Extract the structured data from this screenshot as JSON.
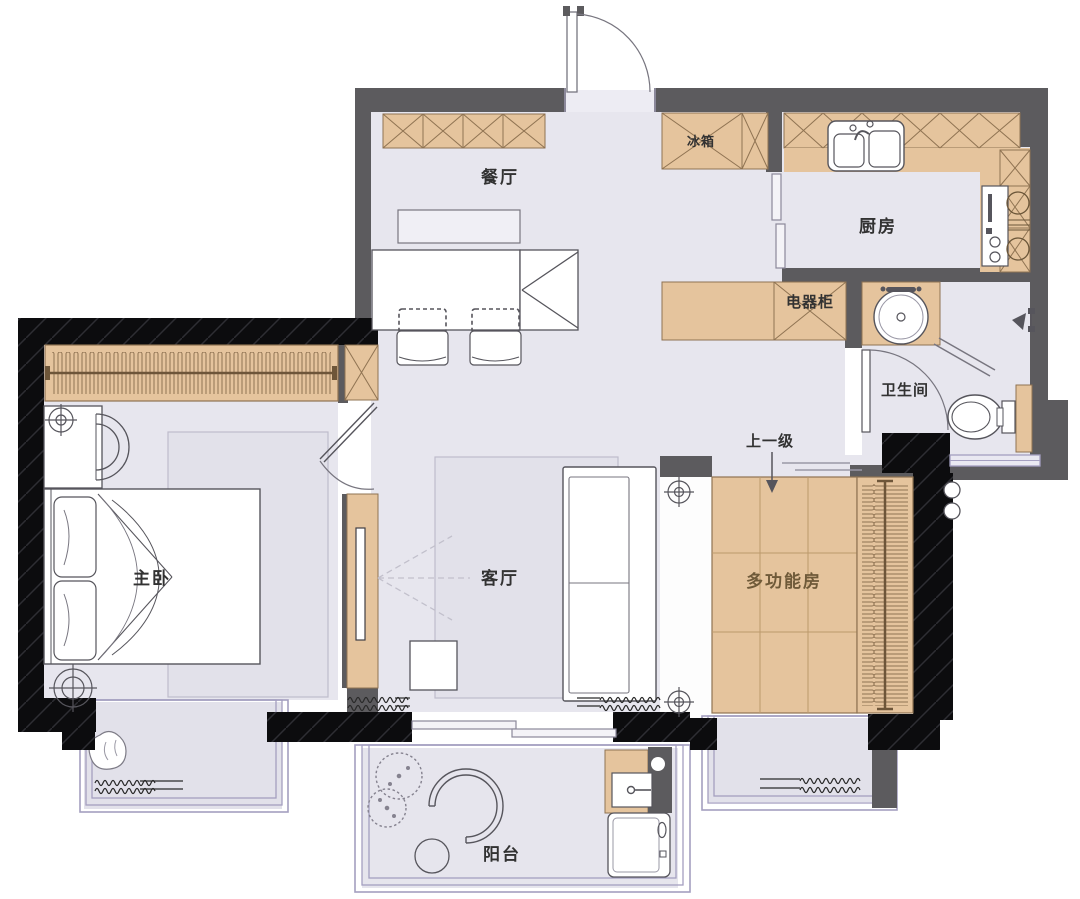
{
  "labels": {
    "dining": "餐厅",
    "fridge": "冰箱",
    "kitchen": "厨房",
    "appliance_cabinet": "电器柜",
    "bathroom": "卫生间",
    "master_bedroom": "主卧",
    "living": "客厅",
    "multi_room": "多功能房",
    "step_up": "上一级",
    "balcony": "阳台"
  },
  "rooms": [
    {
      "id": "dining-room",
      "label": "餐厅",
      "fixtures": [
        "storage-cabinets",
        "dining-table",
        "two-chairs",
        "wall-shelf"
      ]
    },
    {
      "id": "kitchen",
      "label": "厨房",
      "fixtures": [
        "upper-cabinets",
        "double-sink",
        "cooktop",
        "sliding-door",
        "refrigerator"
      ]
    },
    {
      "id": "hallway",
      "label": "电器柜",
      "fixtures": [
        "appliance-cabinet"
      ]
    },
    {
      "id": "bathroom",
      "label": "卫生间",
      "fixtures": [
        "round-basin",
        "shower",
        "toilet",
        "swing-door",
        "window"
      ]
    },
    {
      "id": "master-bedroom",
      "label": "主卧",
      "fixtures": [
        "wardrobe-hanging-rail",
        "double-bed",
        "armchair",
        "rug",
        "downlights",
        "swing-door"
      ]
    },
    {
      "id": "living-room",
      "label": "客厅",
      "fixtures": [
        "tv-cabinet",
        "tv",
        "sofa",
        "side-table",
        "rug",
        "curtains",
        "sliding-door"
      ]
    },
    {
      "id": "multi-function-room",
      "label": "多功能房",
      "fixtures": [
        "tatami-platform",
        "wardrobe-hanging-rail",
        "step-up-arrow",
        "downlights"
      ]
    },
    {
      "id": "balcony",
      "label": "阳台",
      "fixtures": [
        "plants",
        "hanging-chair",
        "stool",
        "laundry-sink",
        "washing-machine",
        "sliding-door"
      ]
    },
    {
      "id": "bay-window-left",
      "label": "",
      "fixtures": [
        "plant",
        "curtains"
      ]
    },
    {
      "id": "bay-window-right",
      "label": "",
      "fixtures": [
        "curtains"
      ]
    }
  ],
  "annotations": {
    "step_up_note": "上一级"
  },
  "colors": {
    "wall": "#5c5b5e",
    "wall_load_bearing": "#0c0c0e",
    "floor": "#e7e6ee",
    "rug": "#e2e1ea",
    "wood": "#e5c49d",
    "wood_line": "#8f7352",
    "window_frame": "#a49fc0",
    "fixture_line": "#56555c",
    "label_text": "#323232",
    "label_text_wood": "#6f5a39"
  }
}
